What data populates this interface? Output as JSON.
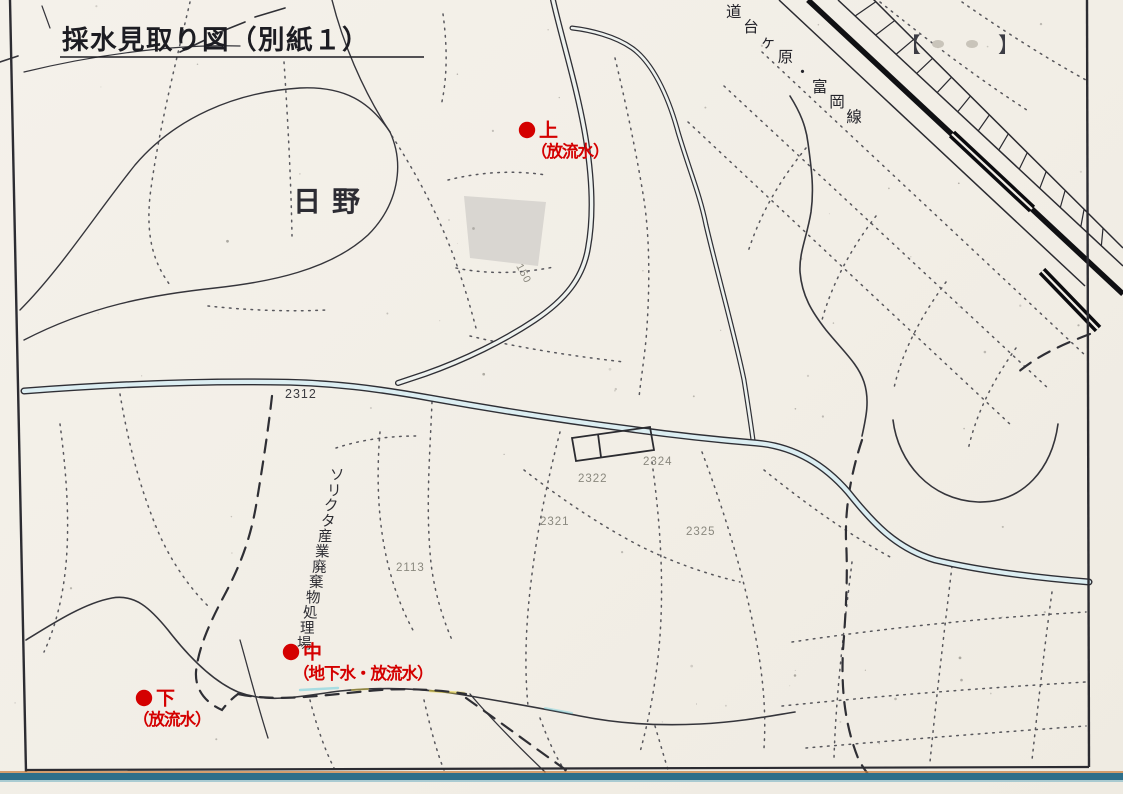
{
  "title": "採水見取り図（別紙１）",
  "map": {
    "place_label": "日野",
    "railway_label": "道台ヶ原・富岡線",
    "facility_label": "ソリクタ産業廃棄物処理場",
    "brackets": {
      "left": "【",
      "right": "】"
    },
    "sampling_points": [
      {
        "id": "upper",
        "name": "上",
        "detail": "（放流水）",
        "x": 527,
        "y": 130,
        "detail_dx": 4
      },
      {
        "id": "middle",
        "name": "中",
        "detail": "（地下水・放流水）",
        "x": 291,
        "y": 652,
        "detail_dx": 2
      },
      {
        "id": "lower",
        "name": "下",
        "detail": "（放流水）",
        "x": 144,
        "y": 698,
        "detail_dx": -11
      }
    ],
    "parcel_numbers": [
      {
        "value": "2312",
        "x": 285,
        "y": 398,
        "dark": true
      },
      {
        "value": "2324",
        "x": 643,
        "y": 465
      },
      {
        "value": "2322",
        "x": 578,
        "y": 482
      },
      {
        "value": "2321",
        "x": 540,
        "y": 525
      },
      {
        "value": "2325",
        "x": 686,
        "y": 535
      },
      {
        "value": "2113",
        "x": 396,
        "y": 571
      },
      {
        "value": "150",
        "x": 516,
        "y": 266,
        "rot": 62,
        "small": true
      }
    ],
    "colors": {
      "marker_red": "#d40000",
      "ink": "#2b2b31",
      "paper": "#f2eee7"
    }
  }
}
